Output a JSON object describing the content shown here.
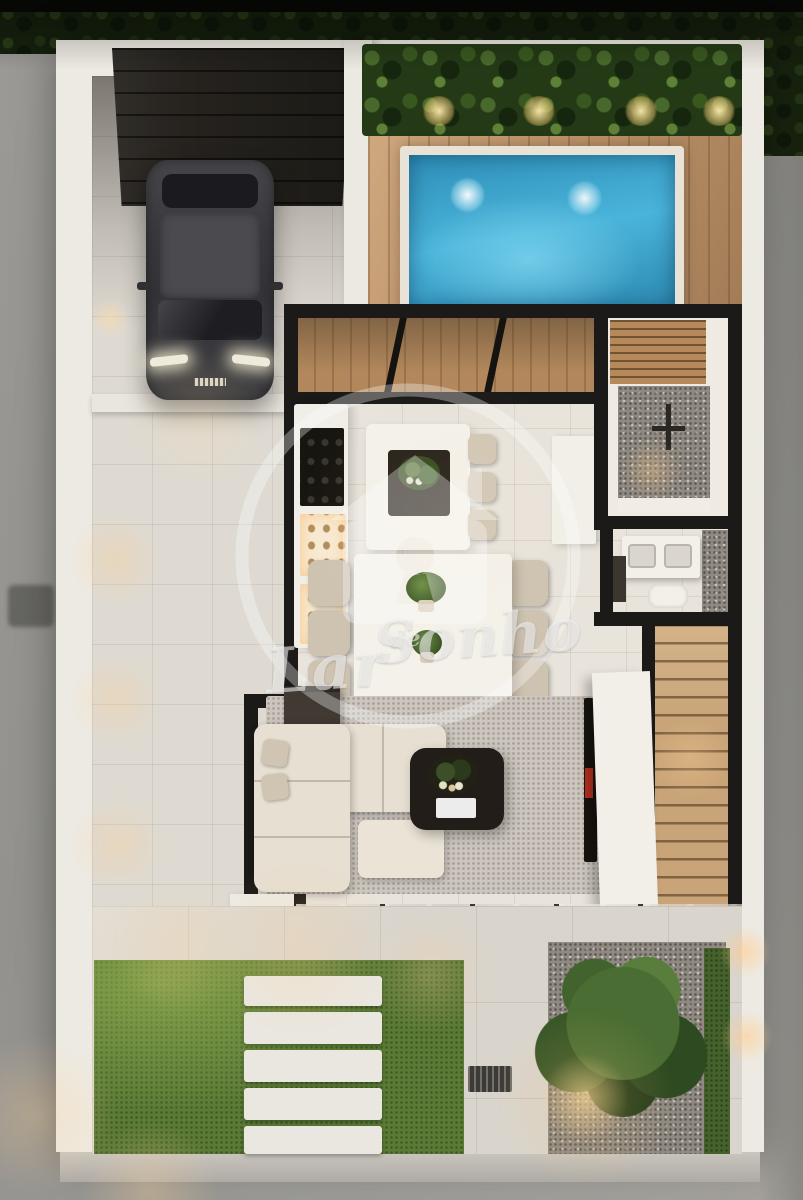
{
  "watermark": {
    "logo": "house-keyhole-logo",
    "word1": "Lar",
    "word2": "de",
    "word3": "Sonho",
    "full_text": "Lar de Sonho"
  },
  "scene": {
    "type": "3d-floor-plan-render",
    "view": "top-down evening aerial render of a modern single-family house",
    "regions": [
      "street",
      "perimeter-hedge",
      "perimeter-wall",
      "garage-carport",
      "car",
      "pool-deck",
      "swimming-pool",
      "planter-hedge",
      "kitchen-counter",
      "kitchen-island",
      "dining-area",
      "living-room",
      "tv-partition",
      "staircase",
      "shower-room",
      "toilet-room",
      "north-glass-wall",
      "south-glass-wall",
      "back-patio",
      "lawn",
      "stepping-stones",
      "gravel-garden",
      "tree",
      "drain-grate"
    ],
    "colors": {
      "street": "#96958f",
      "perimeter_wall": "#edeae3",
      "interior_wall": "#1b1a18",
      "deck_wood": "#bf946a",
      "pool_water": "#3fa9d0",
      "pool_coping": "#e8e2d7",
      "interior_floor": "#e8e3db",
      "lawn": "#5a7a35",
      "gravel": "#b4aca1",
      "sofa": "#e6dfd2",
      "rug": "#ccc6be",
      "stair_wood": "#c9a478",
      "car_body": "#3a3a3e",
      "hedge": "#17220e",
      "warm_light": "#ffcd8c",
      "watermark": "rgba(255,255,255,0.5)"
    }
  }
}
